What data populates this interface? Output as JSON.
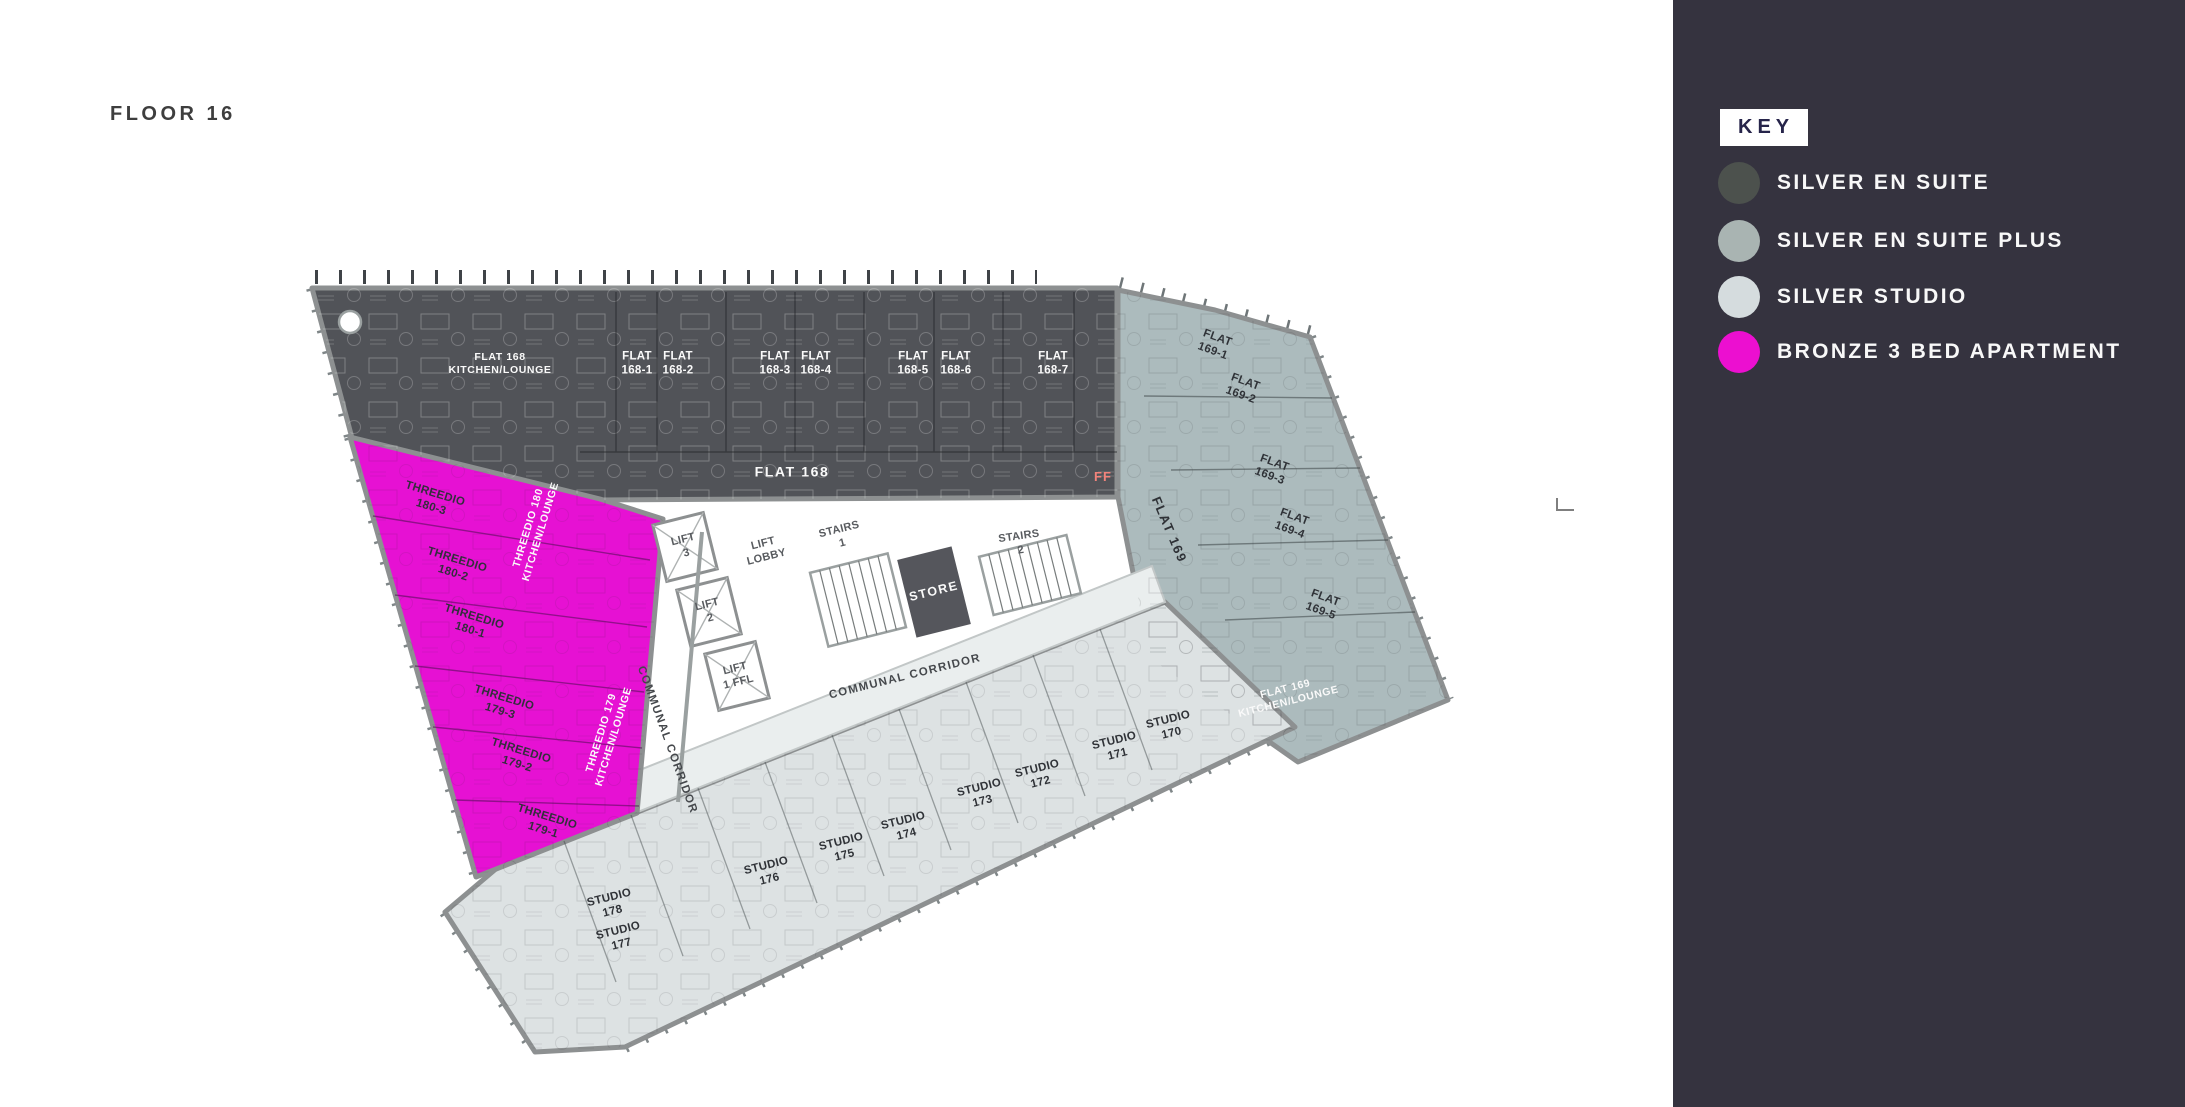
{
  "page": {
    "title": "FLOOR 16"
  },
  "key": {
    "title": "KEY",
    "items": [
      {
        "label": "SILVER EN SUITE",
        "color": "#4C514D"
      },
      {
        "label": "SILVER EN SUITE PLUS",
        "color": "#A9B4B2"
      },
      {
        "label": "SILVER STUDIO",
        "color": "#D5DCDE"
      },
      {
        "label": "BRONZE 3 BED APARTMENT",
        "color": "#EC0FD0"
      }
    ]
  },
  "plan": {
    "regions": {
      "silver_en_suite": "#515358",
      "silver_en_suite_plus": "#ACBBBD",
      "silver_studio": "#DDE2E3",
      "bronze_3_bed": "#E611D3",
      "corridor_shade": "#EAEEEE",
      "store_fill": "#55565C"
    },
    "labels": {
      "flat168_kitchen": "FLAT 168\nKITCHEN/LOUNGE",
      "flat168_corridor": "FLAT 168",
      "ff": "FF",
      "flat168_rooms": [
        "FLAT\n168-1",
        "FLAT\n168-2",
        "FLAT\n168-3",
        "FLAT\n168-4",
        "FLAT\n168-5",
        "FLAT\n168-6",
        "FLAT\n168-7"
      ],
      "flat169_rooms": [
        "FLAT\n169-1",
        "FLAT\n169-2",
        "FLAT\n169-3",
        "FLAT\n169-4",
        "FLAT\n169-5"
      ],
      "flat169_corridor": "FLAT 169",
      "flat169_kitchen": "FLAT 169\nKITCHEN/LOUNGE",
      "threedio_180_rooms": [
        "THREEDIO\n180-3",
        "THREEDIO\n180-2",
        "THREEDIO\n180-1"
      ],
      "threedio_180_kitchen": "THREEDIO 180\nKITCHEN/LOUNGE",
      "threedio_179_rooms": [
        "THREEDIO\n179-3",
        "THREEDIO\n179-2",
        "THREEDIO\n179-1"
      ],
      "threedio_179_kitchen": "THREEDIO 179\nKITCHEN/LOUNGE",
      "studios": [
        "STUDIO\n170",
        "STUDIO\n171",
        "STUDIO\n172",
        "STUDIO\n173",
        "STUDIO\n174",
        "STUDIO\n175",
        "STUDIO\n176",
        "STUDIO\n177",
        "STUDIO\n178"
      ],
      "communal_corridor_bottom": "COMMUNAL CORRIDOR",
      "communal_corridor_left": "COMMUNAL CORRIDOR",
      "lift_lobby": "LIFT\nLOBBY",
      "lift_3": "LIFT\n3",
      "lift_2": "LIFT\n2",
      "lift_1": "LIFT\n1 FFL",
      "stairs_1": "STAIRS\n1",
      "stairs_2": "STAIRS\n2",
      "store": "STORE"
    }
  }
}
